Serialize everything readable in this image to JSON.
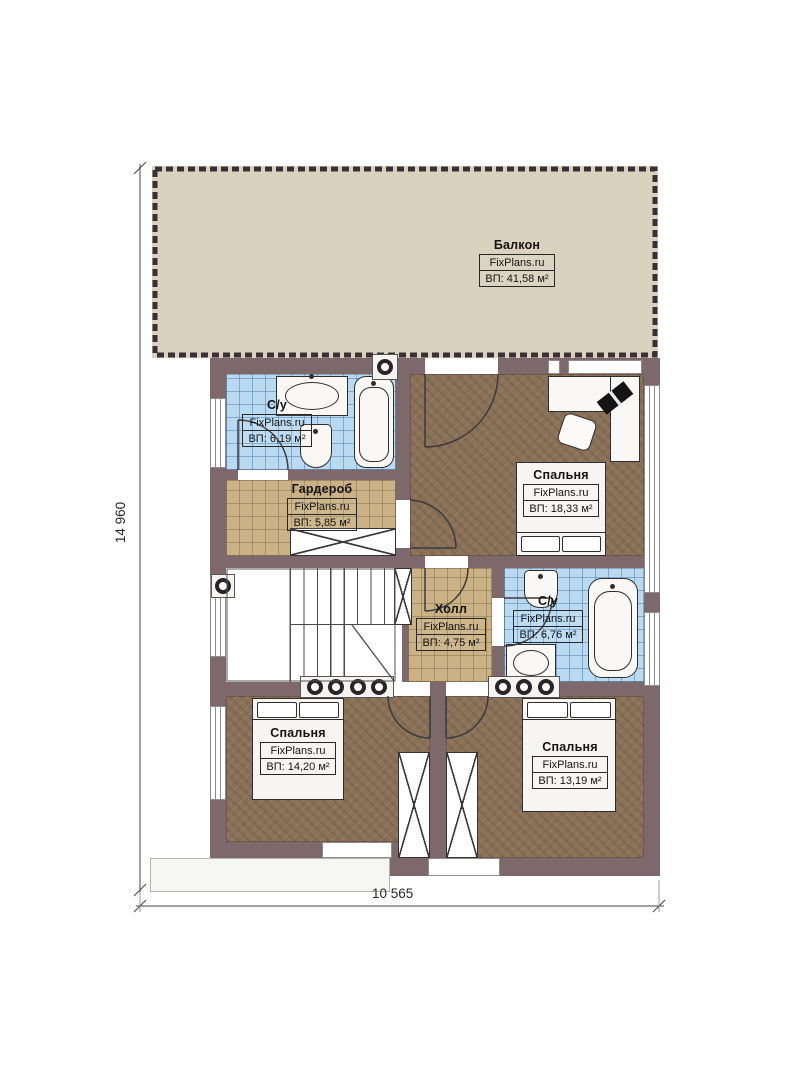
{
  "plan": {
    "title": "Floor plan level 2",
    "brand": "FixPlans.ru",
    "dimensions": {
      "height_label": "14 960",
      "width_label": "10 565"
    },
    "rooms": [
      {
        "id": "balcony",
        "name": "Балкон",
        "brand": "FixPlans.ru",
        "area": "ВП: 41,58 м²"
      },
      {
        "id": "bathroom-top-left",
        "name": "С/у",
        "brand": "FixPlans.ru",
        "area": "ВП: 6,19 м²"
      },
      {
        "id": "wardrobe",
        "name": "Гардероб",
        "brand": "FixPlans.ru",
        "area": "ВП: 5,85 м²"
      },
      {
        "id": "bedroom-top-right",
        "name": "Спальня",
        "brand": "FixPlans.ru",
        "area": "ВП: 18,33 м²"
      },
      {
        "id": "hall",
        "name": "Холл",
        "brand": "FixPlans.ru",
        "area": "ВП: 4,75 м²"
      },
      {
        "id": "bathroom-right",
        "name": "С/у",
        "brand": "FixPlans.ru",
        "area": "ВП: 6,76 м²"
      },
      {
        "id": "bedroom-bottom-left",
        "name": "Спальня",
        "brand": "FixPlans.ru",
        "area": "ВП: 14,20 м²"
      },
      {
        "id": "bedroom-bottom-right",
        "name": "Спальня",
        "brand": "FixPlans.ru",
        "area": "ВП: 13,19 м²"
      }
    ],
    "colors": {
      "wall": "#7d696c",
      "floor_wood": "#8a7157",
      "floor_tile": "#badaf2",
      "floor_grid": "#cbb286",
      "balcony": "#dad2bf",
      "ink": "#272727"
    }
  }
}
